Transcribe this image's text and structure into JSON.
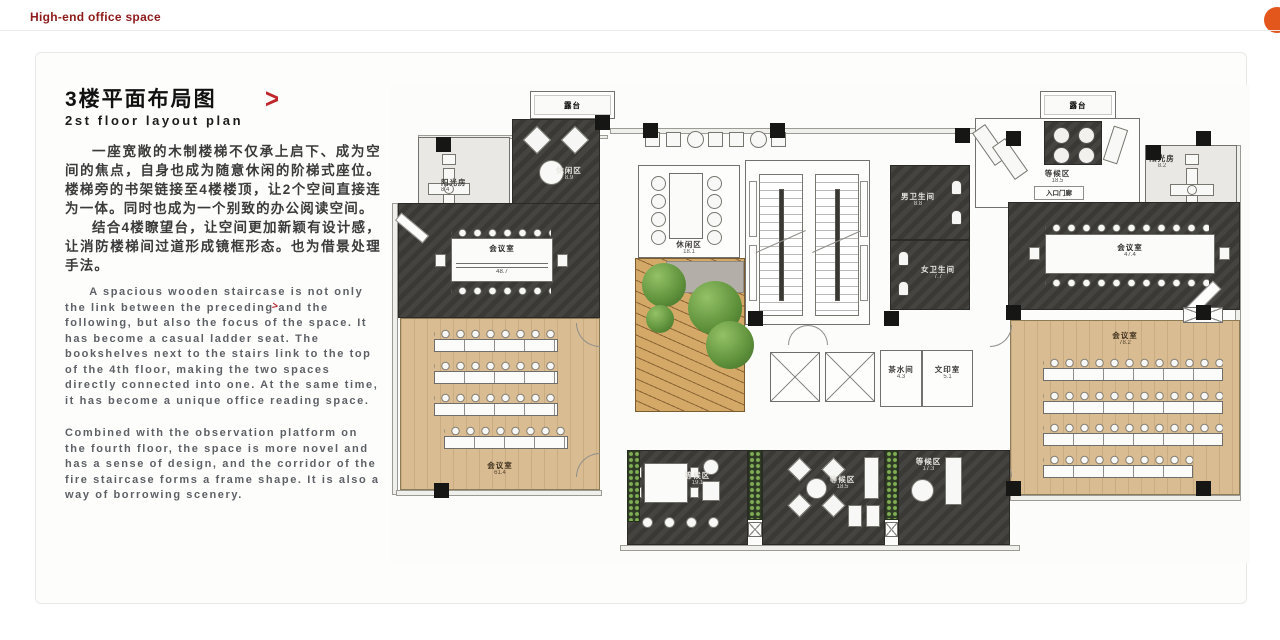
{
  "slide": {
    "brand": "High-end office space",
    "title_cn": "3楼平面布局图",
    "title_en": "2st floor layout plan",
    "arrow": ">",
    "paragraph_cn_1": "一座宽敞的木制楼梯不仅承上启下、成为空间的焦点，自身也成为随意休闲的阶梯式座位。楼梯旁的书架链接至4楼楼顶，让2个空间直接连为一体。同时也成为一个别致的办公阅读空间。",
    "paragraph_cn_2": "结合4楼瞭望台，让空间更加新颖有设计感，让消防楼梯间过道形成镜框形态。也为借景处理手法。",
    "paragraph_en_1": "A spacious wooden staircase is not only the link between the preceding and the following, but also the focus of the space. It has become a casual ladder seat. The bookshelves next to the stairs link to the top of the 4th floor, making the two spaces directly connected into one. At the same time, it has become a unique office reading space.",
    "paragraph_en_2": "Combined with the observation platform on the fourth floor, the space is more novel and has a sense of design, and the corridor of the fire staircase forms a frame shape. It is also a way of borrowing scenery."
  },
  "colors": {
    "brand_red": "#8E1B1B",
    "accent_red": "#C0272D",
    "orange_badge": "#E4571C",
    "dark_room": "#3D3C38",
    "wood_floor": "#D9BC92",
    "plant_green": "#6FA84E"
  },
  "plan": {
    "rooms": [
      {
        "id": "terrace-left",
        "label": "露台",
        "area": ""
      },
      {
        "id": "sunroom-left",
        "label": "阳光房",
        "area": "8.4"
      },
      {
        "id": "lounge-top-left",
        "label": "休闲区",
        "area": "8.9"
      },
      {
        "id": "meeting-left",
        "label": "会议室",
        "area": "48.7"
      },
      {
        "id": "classroom-left",
        "label": "会议室",
        "area": "61.4"
      },
      {
        "id": "lounge-center",
        "label": "休闲区",
        "area": "18.1"
      },
      {
        "id": "wc-men",
        "label": "男卫生间",
        "area": "8.8"
      },
      {
        "id": "wc-women",
        "label": "女卫生间",
        "area": "7.7"
      },
      {
        "id": "tea-room",
        "label": "茶水间",
        "area": "4.3"
      },
      {
        "id": "print-room",
        "label": "文印室",
        "area": "5.1"
      },
      {
        "id": "terrace-right",
        "label": "露台",
        "area": ""
      },
      {
        "id": "waiting-top-right",
        "label": "等候区",
        "area": "18.5"
      },
      {
        "id": "entrance-porch",
        "label": "入口门廊",
        "area": ""
      },
      {
        "id": "sunroom-right",
        "label": "阳光房",
        "area": "8.2"
      },
      {
        "id": "meeting-right",
        "label": "会议室",
        "area": "47.4"
      },
      {
        "id": "classroom-right",
        "label": "会议室",
        "area": "78.2"
      },
      {
        "id": "waiting-bottom-1",
        "label": "等候区",
        "area": "19.1"
      },
      {
        "id": "waiting-bottom-2",
        "label": "等候区",
        "area": "18.5"
      },
      {
        "id": "waiting-bottom-3",
        "label": "等候区",
        "area": "17.3"
      }
    ]
  }
}
